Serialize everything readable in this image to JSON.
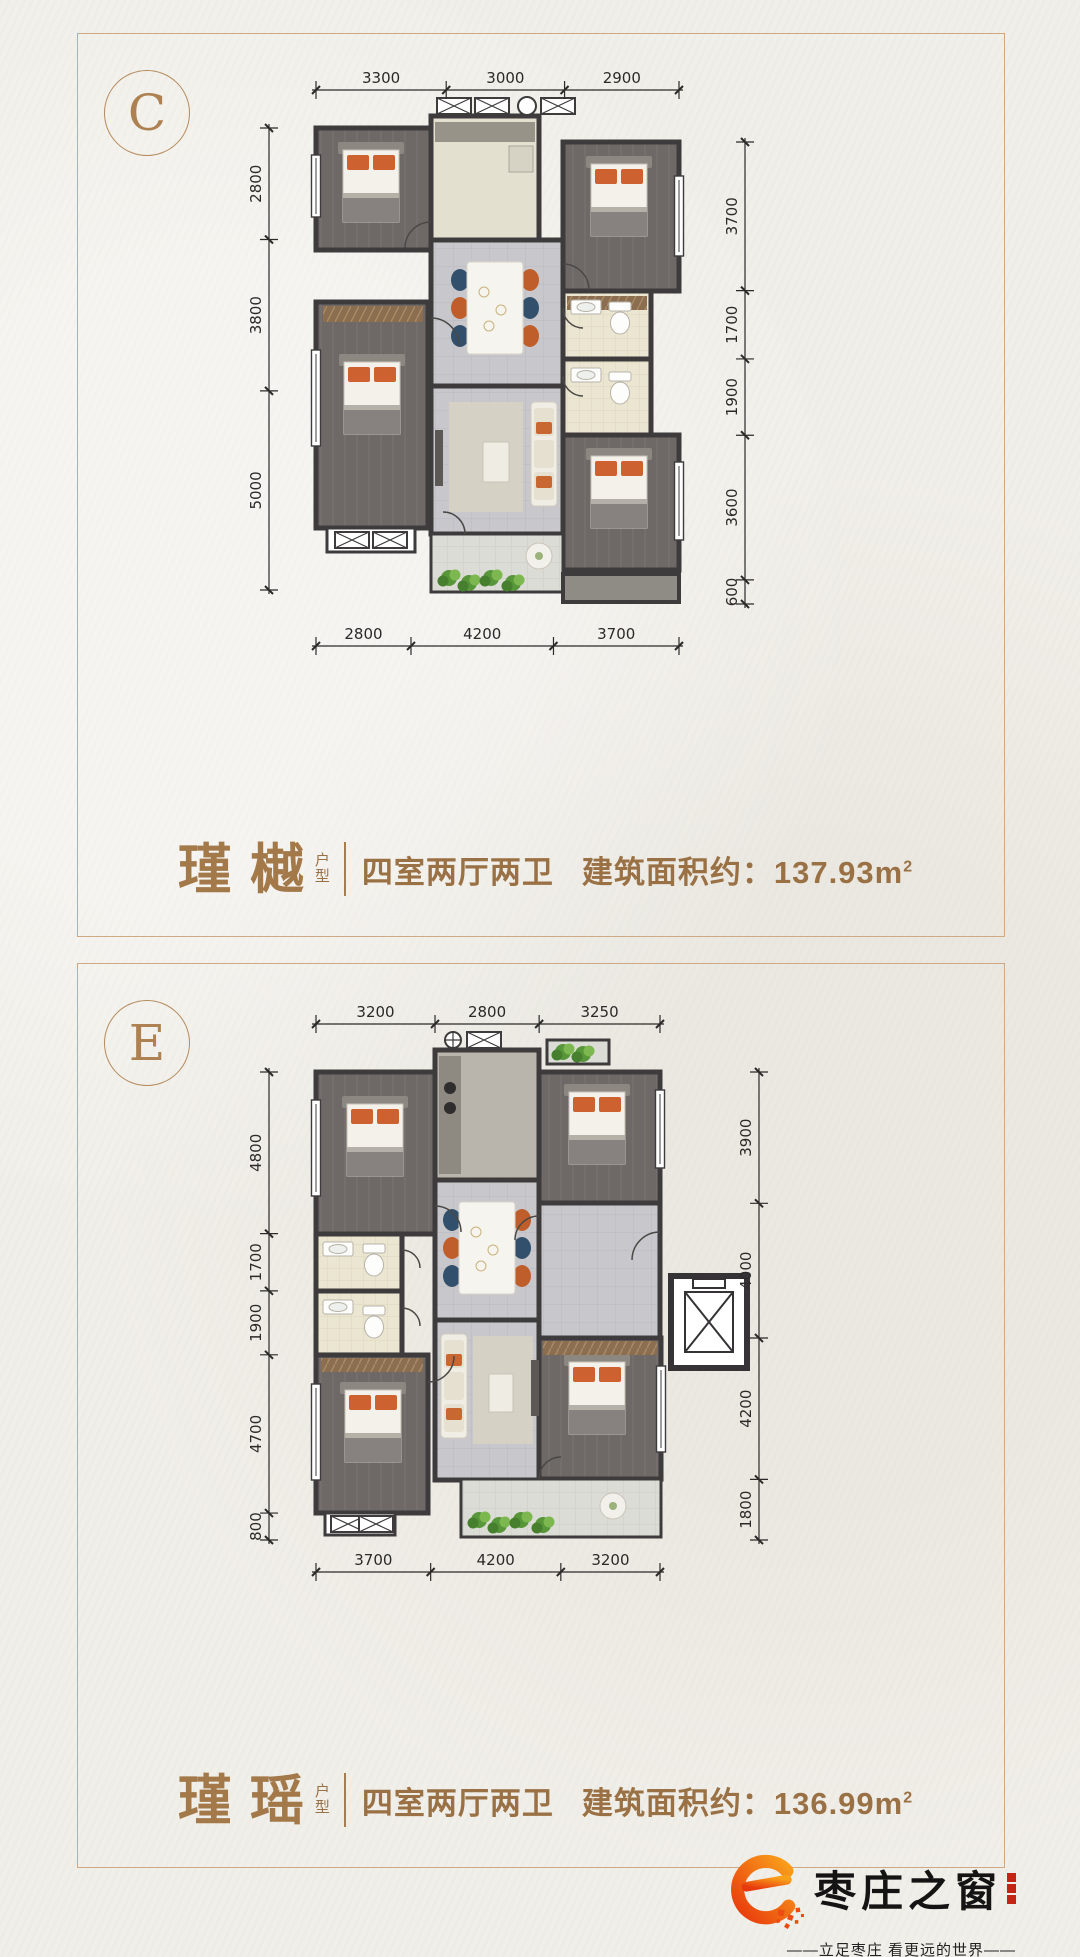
{
  "panels": [
    {
      "badge": "C",
      "name_chars": [
        "瑾",
        "樾"
      ],
      "type_chars": [
        "户",
        "型"
      ],
      "rooms_label": "四室两厅两卫",
      "area_label": "建筑面积约：",
      "area_value": "137.93",
      "area_unit": "m",
      "area_sup": "2",
      "dims": {
        "top": [
          "3300",
          "3000",
          "2900"
        ],
        "left": [
          "2800",
          "3800",
          "5000"
        ],
        "right": [
          "3700",
          "1700",
          "1900",
          "3600",
          "600"
        ],
        "bottom": [
          "2800",
          "4200",
          "3700"
        ]
      }
    },
    {
      "badge": "E",
      "name_chars": [
        "瑾",
        "瑶"
      ],
      "type_chars": [
        "户",
        "型"
      ],
      "rooms_label": "四室两厅两卫",
      "area_label": "建筑面积约：",
      "area_value": "136.99",
      "area_unit": "m",
      "area_sup": "2",
      "dims": {
        "top": [
          "3200",
          "2800",
          "3250"
        ],
        "left": [
          "4800",
          "1700",
          "1900",
          "4700",
          "800"
        ],
        "right": [
          "3900",
          "4000",
          "4200",
          "1800"
        ],
        "bottom": [
          "3700",
          "4200",
          "3200"
        ]
      }
    }
  ],
  "footer": {
    "brand": "枣庄之窗",
    "tagline": "——立足枣庄 看更远的世界——"
  },
  "colors": {
    "accent_brown": "#a3794a",
    "panel_border": "#cfa884",
    "dim_text": "#2b2a29",
    "wall": "#3d3b3c",
    "logo_orange_1": "#e8380d",
    "logo_orange_2": "#f9a01b"
  }
}
